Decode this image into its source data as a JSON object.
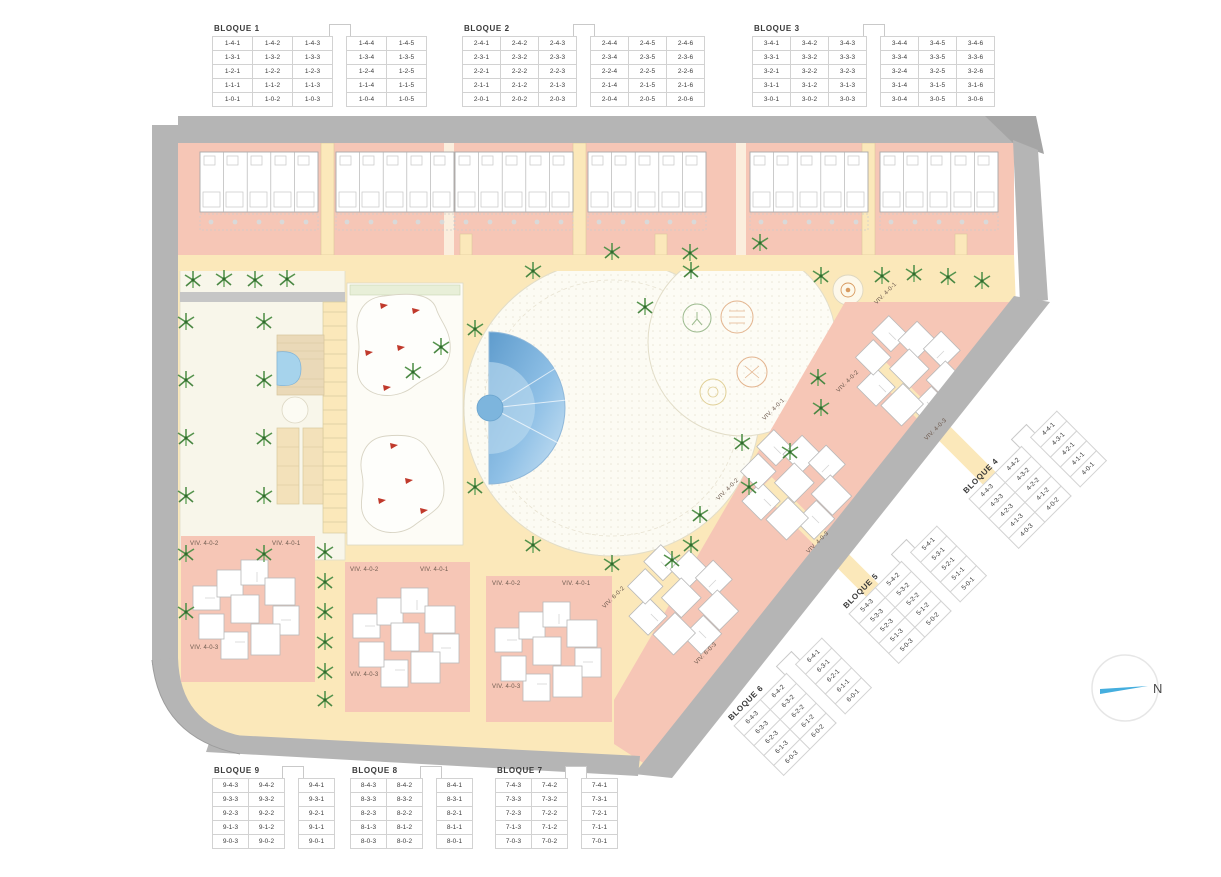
{
  "north_label": "N",
  "colors": {
    "building_salmon": "#f6c6b6",
    "path_yellow": "#fbe8ba",
    "road_gray": "#b5b5b5",
    "road_gray_dark": "#a5a5a5",
    "pool_blue": "#7cb5de",
    "tree_green": "#55934d",
    "north_arrow_blue": "#45aede",
    "plaza_white": "#fcfbf3"
  },
  "bloques": [
    {
      "title": "BLOQUE 1",
      "gap_after": 3,
      "rows": [
        [
          "1-4-1",
          "1-4-2",
          "1-4-3",
          "1-4-4",
          "1-4-5"
        ],
        [
          "1-3-1",
          "1-3-2",
          "1-3-3",
          "1-3-4",
          "1-3-5"
        ],
        [
          "1-2-1",
          "1-2-2",
          "1-2-3",
          "1-2-4",
          "1-2-5"
        ],
        [
          "1-1-1",
          "1-1-2",
          "1-1-3",
          "1-1-4",
          "1-1-5"
        ],
        [
          "1-0-1",
          "1-0-2",
          "1-0-3",
          "1-0-4",
          "1-0-5"
        ]
      ]
    },
    {
      "title": "BLOQUE 2",
      "gap_after": 3,
      "rows": [
        [
          "2-4-1",
          "2-4-2",
          "2-4-3",
          "2-4-4",
          "2-4-5",
          "2-4-6"
        ],
        [
          "2-3-1",
          "2-3-2",
          "2-3-3",
          "2-3-4",
          "2-3-5",
          "2-3-6"
        ],
        [
          "2-2-1",
          "2-2-2",
          "2-2-3",
          "2-2-4",
          "2-2-5",
          "2-2-6"
        ],
        [
          "2-1-1",
          "2-1-2",
          "2-1-3",
          "2-1-4",
          "2-1-5",
          "2-1-6"
        ],
        [
          "2-0-1",
          "2-0-2",
          "2-0-3",
          "2-0-4",
          "2-0-5",
          "2-0-6"
        ]
      ]
    },
    {
      "title": "BLOQUE 3",
      "gap_after": 3,
      "rows": [
        [
          "3-4-1",
          "3-4-2",
          "3-4-3",
          "3-4-4",
          "3-4-5",
          "3-4-6"
        ],
        [
          "3-3-1",
          "3-3-2",
          "3-3-3",
          "3-3-4",
          "3-3-5",
          "3-3-6"
        ],
        [
          "3-2-1",
          "3-2-2",
          "3-2-3",
          "3-2-4",
          "3-2-5",
          "3-2-6"
        ],
        [
          "3-1-1",
          "3-1-2",
          "3-1-3",
          "3-1-4",
          "3-1-5",
          "3-1-6"
        ],
        [
          "3-0-1",
          "3-0-2",
          "3-0-3",
          "3-0-4",
          "3-0-5",
          "3-0-6"
        ]
      ]
    },
    {
      "title": "BLOQUE 4",
      "gap_after": 2,
      "rows": [
        [
          "4-4-3",
          "4-4-2",
          "4-4-1"
        ],
        [
          "4-3-3",
          "4-3-2",
          "4-3-1"
        ],
        [
          "4-2-3",
          "4-2-2",
          "4-2-1"
        ],
        [
          "4-1-3",
          "4-1-2",
          "4-1-1"
        ],
        [
          "4-0-3",
          "4-0-2",
          "4-0-1"
        ]
      ]
    },
    {
      "title": "BLOQUE  5",
      "gap_after": 2,
      "rows": [
        [
          "5-4-3",
          "5-4-2",
          "5-4-1"
        ],
        [
          "5-3-3",
          "5-3-2",
          "5-3-1"
        ],
        [
          "5-2-3",
          "5-2-2",
          "5-2-1"
        ],
        [
          "5-1-3",
          "5-1-2",
          "5-1-1"
        ],
        [
          "5-0-3",
          "5-0-2",
          "5-0-1"
        ]
      ]
    },
    {
      "title": "BLOQUE  6",
      "gap_after": 2,
      "rows": [
        [
          "6-4-3",
          "6-4-2",
          "6-4-1"
        ],
        [
          "6-3-3",
          "6-3-2",
          "6-3-1"
        ],
        [
          "6-2-3",
          "6-2-2",
          "6-2-1"
        ],
        [
          "6-1-3",
          "6-1-2",
          "6-1-1"
        ],
        [
          "6-0-3",
          "6-0-2",
          "6-0-1"
        ]
      ]
    },
    {
      "title": "BLOQUE 7",
      "gap_after": 2,
      "rows": [
        [
          "7-4-3",
          "7-4-2",
          "7-4-1"
        ],
        [
          "7-3-3",
          "7-3-2",
          "7-3-1"
        ],
        [
          "7-2-3",
          "7-2-2",
          "7-2-1"
        ],
        [
          "7-1-3",
          "7-1-2",
          "7-1-1"
        ],
        [
          "7-0-3",
          "7-0-2",
          "7-0-1"
        ]
      ]
    },
    {
      "title": "BLOQUE 8",
      "gap_after": 2,
      "rows": [
        [
          "8-4-3",
          "8-4-2",
          "8-4-1"
        ],
        [
          "8-3-3",
          "8-3-2",
          "8-3-1"
        ],
        [
          "8-2-3",
          "8-2-2",
          "8-2-1"
        ],
        [
          "8-1-3",
          "8-1-2",
          "8-1-1"
        ],
        [
          "8-0-3",
          "8-0-2",
          "8-0-1"
        ]
      ]
    },
    {
      "title": "BLOQUE 9",
      "gap_after": 2,
      "rows": [
        [
          "9-4-3",
          "9-4-2",
          "9-4-1"
        ],
        [
          "9-3-3",
          "9-3-2",
          "9-3-1"
        ],
        [
          "9-2-3",
          "9-2-2",
          "9-2-1"
        ],
        [
          "9-1-3",
          "9-1-2",
          "9-1-1"
        ],
        [
          "9-0-3",
          "9-0-2",
          "9-0-1"
        ]
      ]
    }
  ],
  "viv_labels": [
    {
      "text": "VIV. 4-0-2"
    },
    {
      "text": "VIV. 4-0-1"
    },
    {
      "text": "VIV. 4-0-3"
    },
    {
      "text": "VIV. 4-0-2"
    },
    {
      "text": "VIV. 4-0-1"
    },
    {
      "text": "VIV. 4-0-3"
    },
    {
      "text": "VIV. 4-0-2"
    },
    {
      "text": "VIV. 4-0-1"
    },
    {
      "text": "VIV. 4-0-3"
    },
    {
      "text": "VIV. 4-0-1"
    },
    {
      "text": "VIV. 4-0-2"
    },
    {
      "text": "VIV. 4-0-3"
    },
    {
      "text": "VIV. 4-0-1"
    },
    {
      "text": "VIV. 4-0-2"
    },
    {
      "text": "VIV. 4-0-3"
    },
    {
      "text": "VIV. 6-0-2"
    },
    {
      "text": "VIV. 6-0-3"
    }
  ]
}
